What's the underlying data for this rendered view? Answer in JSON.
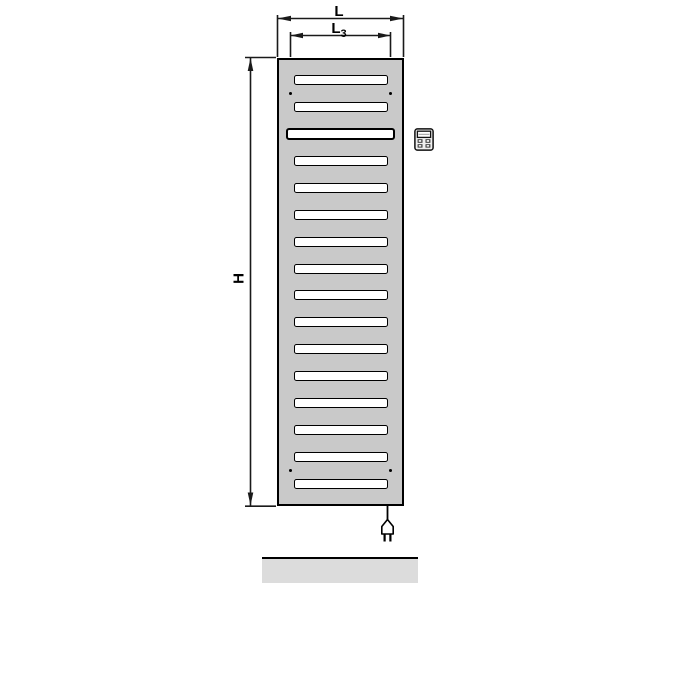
{
  "diagram": {
    "type": "technical-dimension-drawing",
    "subject": "electric panel radiator, front view with dimension lines",
    "labels": {
      "overall_width": "L",
      "inner_width_base": "L",
      "inner_width_sub": "3",
      "overall_height": "H"
    },
    "radiator": {
      "slot_count": 16,
      "wide_slot_position": 3,
      "mounting_dot_count": 4
    },
    "icons": {
      "control_unit": "control-unit-icon",
      "power_plug": "power-plug-icon"
    },
    "colors": {
      "radiator_fill": "#c9c9c9",
      "slot_fill": "#ffffff",
      "outline": "#000000",
      "floor_fill": "#dcdcdc",
      "background": "#ffffff"
    }
  }
}
